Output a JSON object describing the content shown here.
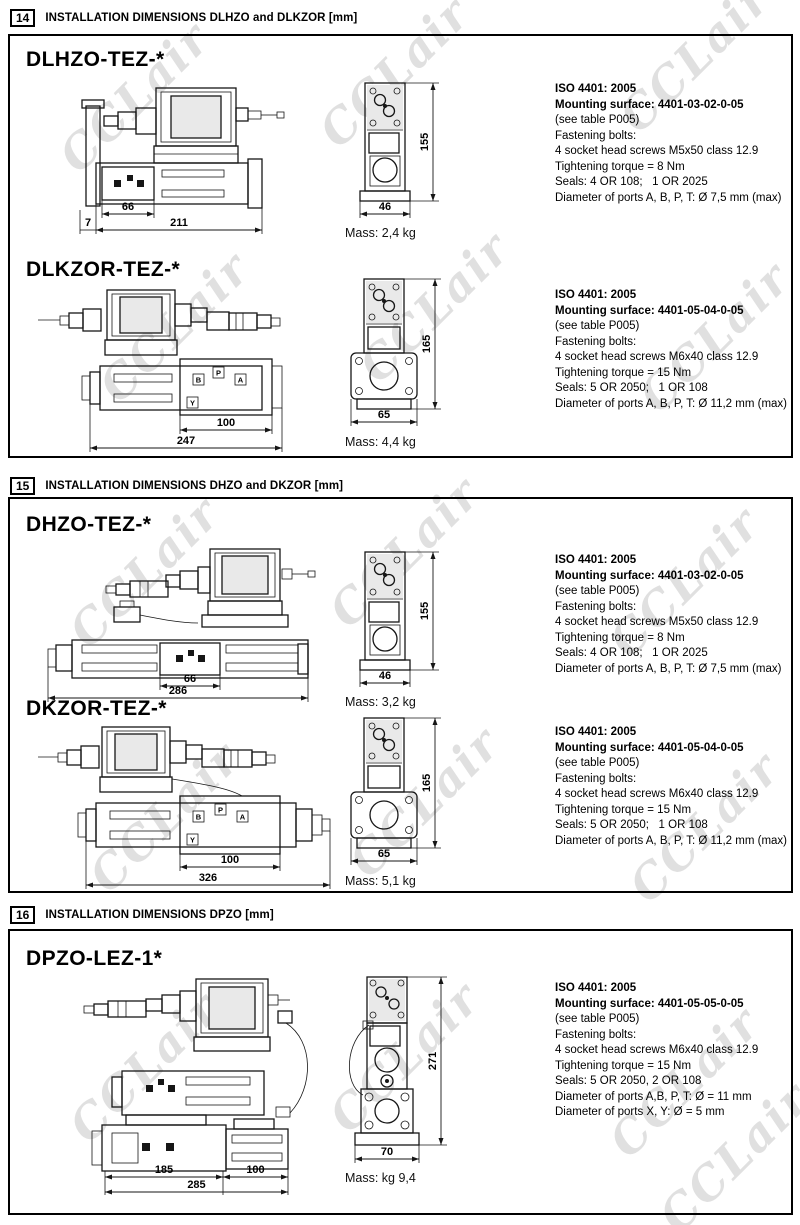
{
  "watermark": {
    "text": "CCLair"
  },
  "sections": [
    {
      "number": "14",
      "title": "INSTALLATION DIMENSIONS DLHZO and DLKZOR [mm]",
      "valves": [
        {
          "name": "DLHZO-TEZ-*",
          "mass": "Mass: 2,4 kg",
          "dims": {
            "a": "7",
            "b": "66",
            "c": "211",
            "h": "155",
            "w": "46"
          },
          "iso": [
            "ISO 4401: 2005",
            "Mounting surface: 4401-03-02-0-05",
            "(see table P005)",
            "Fastening bolts:",
            "4 socket head screws M5x50 class 12.9",
            "Tightening torque = 8 Nm",
            "Seals: 4 OR 108;   1 OR 2025",
            "Diameter of ports A, B, P, T: Ø 7,5 mm (max)"
          ]
        },
        {
          "name": "DLKZOR-TEZ-*",
          "mass": "Mass: 4,4 kg",
          "dims": {
            "b": "100",
            "c": "247",
            "h": "165",
            "w": "65"
          },
          "ports": [
            "B",
            "P",
            "A",
            "Y"
          ],
          "iso": [
            "ISO 4401: 2005",
            "Mounting surface: 4401-05-04-0-05",
            "(see table P005)",
            "Fastening bolts:",
            "4 socket head screws M6x40 class 12.9",
            "Tightening torque = 15 Nm",
            "Seals: 5 OR 2050;   1 OR 108",
            "Diameter of ports A, B, P, T: Ø 11,2 mm (max)"
          ]
        }
      ]
    },
    {
      "number": "15",
      "title": "INSTALLATION DIMENSIONS DHZO and DKZOR [mm]",
      "valves": [
        {
          "name": "DHZO-TEZ-*",
          "mass": "Mass: 3,2 kg",
          "dims": {
            "b": "66",
            "c": "286",
            "h": "155",
            "w": "46"
          },
          "iso": [
            "ISO 4401: 2005",
            "Mounting surface: 4401-03-02-0-05",
            "(see table P005)",
            "Fastening bolts:",
            "4 socket head screws M5x50 class 12.9",
            "Tightening torque = 8 Nm",
            "Seals: 4 OR 108;   1 OR 2025",
            "Diameter of ports A, B, P, T: Ø 7,5 mm (max)"
          ]
        },
        {
          "name": "DKZOR-TEZ-*",
          "mass": "Mass: 5,1 kg",
          "dims": {
            "b": "100",
            "c": "326",
            "h": "165",
            "w": "65"
          },
          "ports": [
            "B",
            "P",
            "A",
            "Y"
          ],
          "iso": [
            "ISO 4401: 2005",
            "Mounting surface: 4401-05-04-0-05",
            "(see table P005)",
            "Fastening bolts:",
            "4 socket head screws M6x40 class 12.9",
            "Tightening torque = 15 Nm",
            "Seals: 5 OR 2050;   1 OR 108",
            "Diameter of ports A, B, P, T: Ø 11,2 mm (max)"
          ]
        }
      ]
    },
    {
      "number": "16",
      "title": "INSTALLATION DIMENSIONS DPZO [mm]",
      "valves": [
        {
          "name": "DPZO-LEZ-1*",
          "mass": "Mass: kg 9,4",
          "dims": {
            "a": "185",
            "b": "100",
            "c": "285",
            "h": "271",
            "w": "70"
          },
          "iso": [
            "ISO 4401: 2005",
            "Mounting surface: 4401-05-05-0-05",
            "(see table P005)",
            "Fastening bolts:",
            "4 socket head screws M6x40 class 12.9",
            "Tightening torque = 15 Nm",
            "Seals: 5 OR 2050, 2 OR 108",
            "Diameter of ports A,B, P, T: Ø = 11 mm",
            "Diameter of ports X, Y: Ø = 5 mm"
          ]
        }
      ]
    }
  ]
}
